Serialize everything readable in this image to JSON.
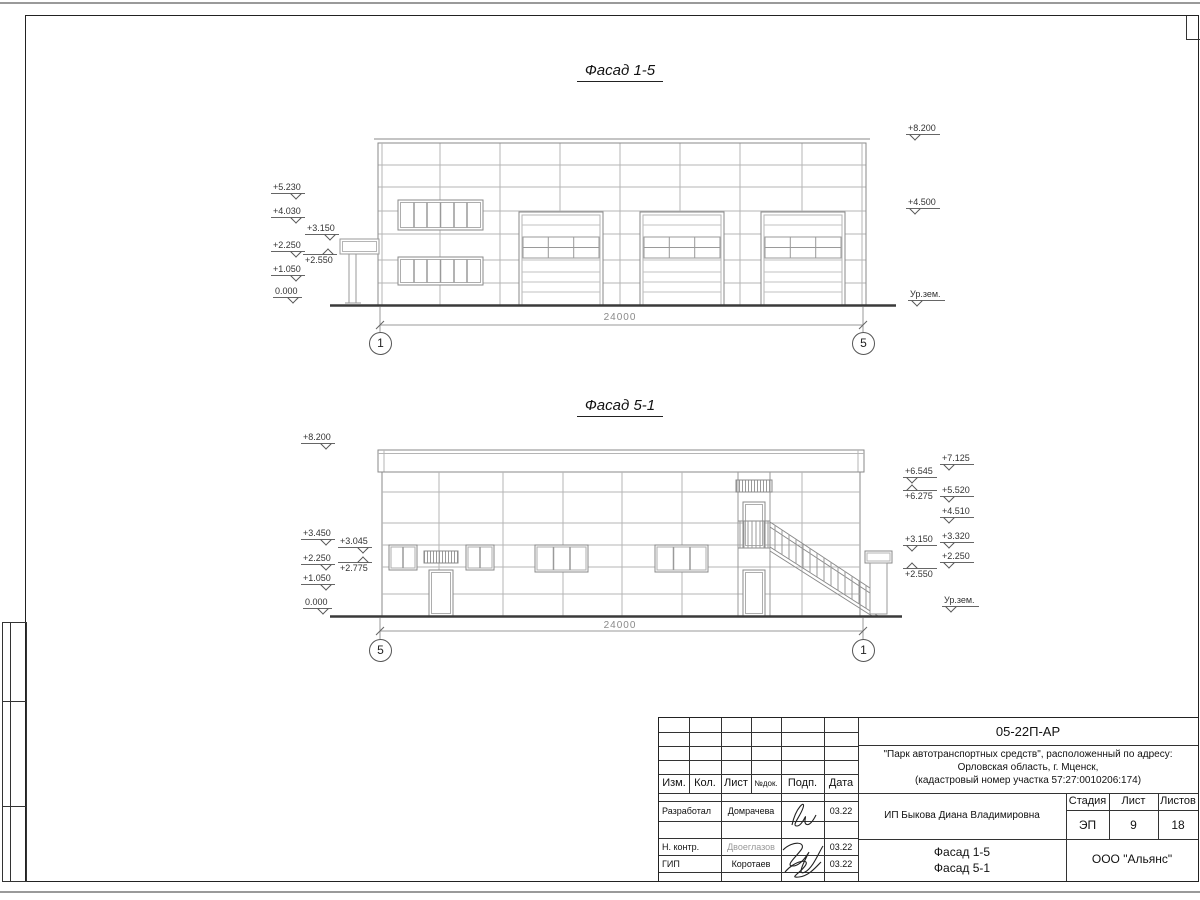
{
  "facade1": {
    "title": "Фасад 1-5",
    "left_marks": [
      "+5.230",
      "+4.030",
      "+3.150",
      "+2.250",
      "+2.550",
      "+1.050",
      "0.000"
    ],
    "right_marks": [
      "+8.200",
      "+4.500",
      "Ур.зем."
    ],
    "dim": "24000",
    "axis_left": "1",
    "axis_right": "5"
  },
  "facade2": {
    "title": "Фасад 5-1",
    "left_marks": [
      "+8.200",
      "+3.450",
      "+3.045",
      "+2.250",
      "+2.775",
      "+1.050",
      "0.000"
    ],
    "right_inner_marks": [
      "+6.545",
      "+6.275",
      "+3.150",
      "+2.550"
    ],
    "right_outer_marks": [
      "+7.125",
      "+5.520",
      "+4.510",
      "+3.320",
      "+2.250",
      "Ур.зем."
    ],
    "dim": "24000",
    "axis_left": "5",
    "axis_right": "1"
  },
  "titleblock": {
    "doc_number": "05-22П-АР",
    "project_line1": "\"Парк автотранспортных средств\",  расположенный по адресу:",
    "project_line2": "Орловская область, г. Мценск,",
    "project_line3": "(кадастровый номер участка 57:27:0010206:174)",
    "col_izm": "Изм.",
    "col_kol": "Кол.",
    "col_list": "Лист",
    "col_ndok": "№док.",
    "col_podp": "Подп.",
    "col_data": "Дата",
    "row1_role": "Разработал",
    "row1_name": "Домрачева",
    "row1_date": "03.22",
    "row2_role": "Н. контр.",
    "row2_name": "Двоеглазов",
    "row2_date": "03.22",
    "row3_role": "ГИП",
    "row3_name": "Коротаев",
    "row3_date": "03.22",
    "client": "ИП Быкова Диана Владимировна",
    "stage_label": "Стадия",
    "sheet_label": "Лист",
    "sheets_label": "Листов",
    "stage": "ЭП",
    "sheet_no": "9",
    "sheets_total": "18",
    "drawing_title1": "Фасад 1-5",
    "drawing_title2": "Фасад 5-1",
    "company": "ООО \"Альянс\""
  }
}
